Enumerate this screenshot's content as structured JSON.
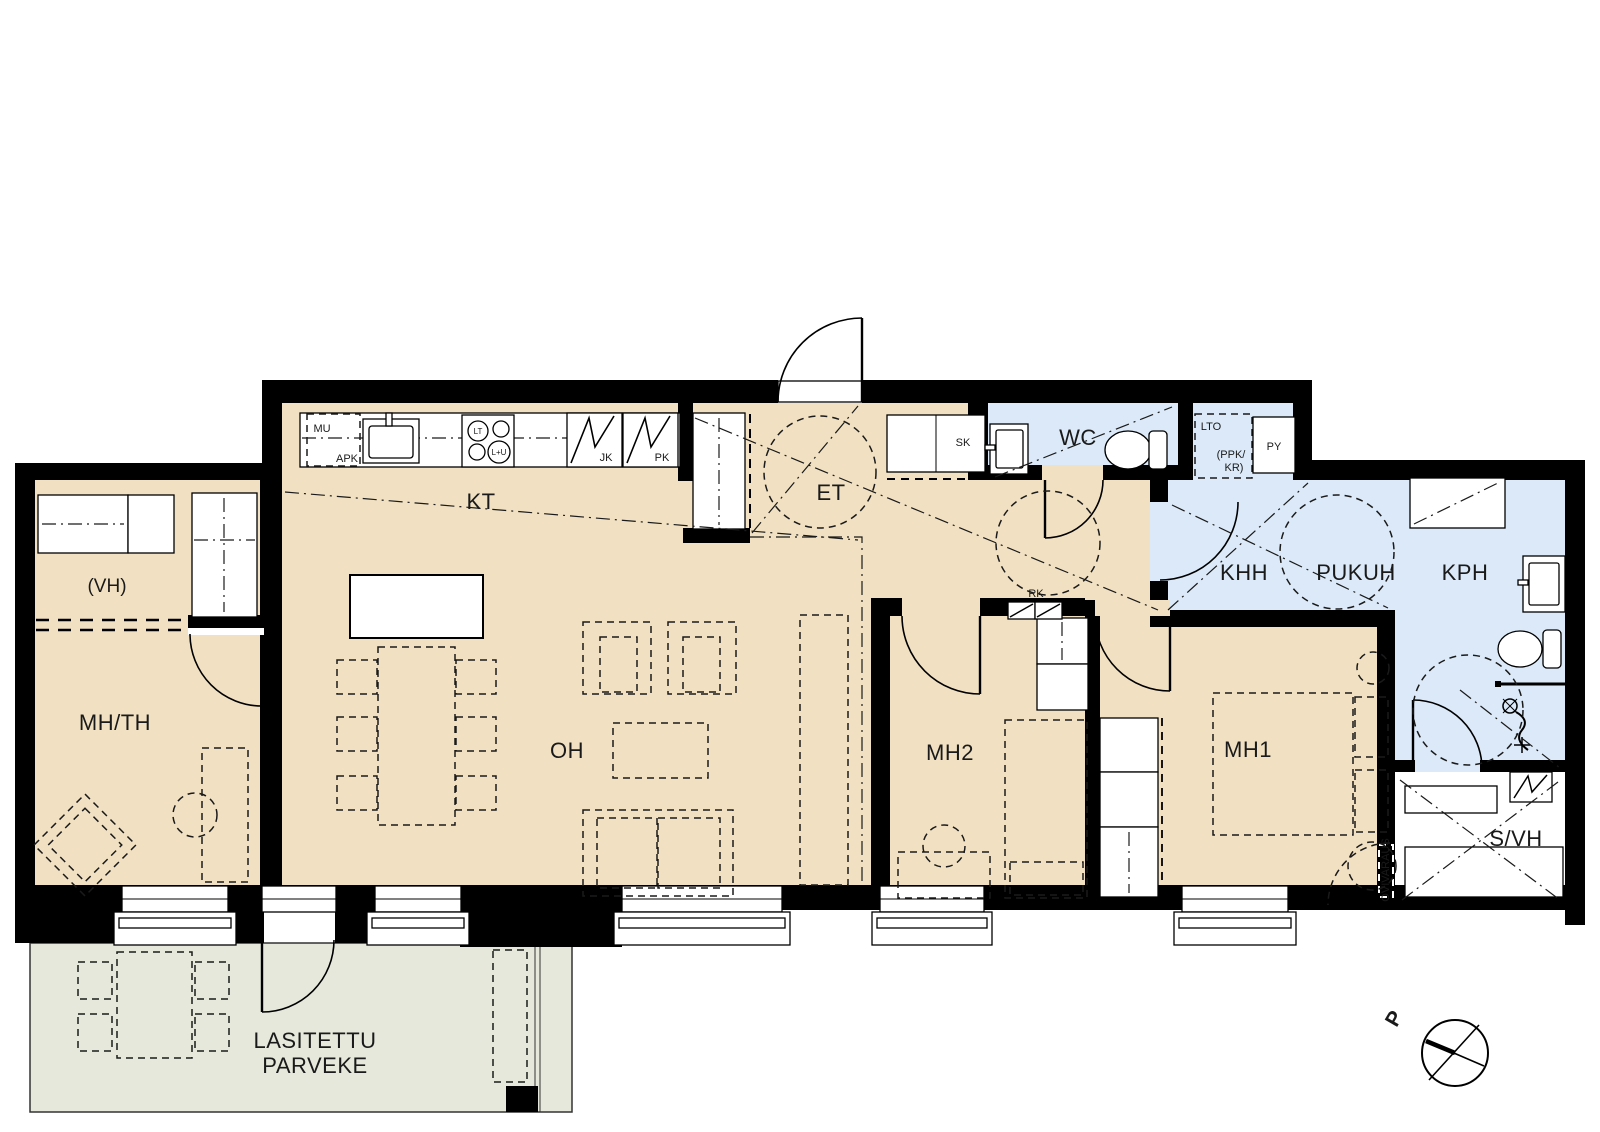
{
  "colors": {
    "floor_dry": "#f1e1c2",
    "floor_wet": "#dbe9f8",
    "balcony": "#e5e8db",
    "wall": "#000000",
    "background": "#ffffff"
  },
  "rooms": {
    "kitchen": "KT",
    "entry": "ET",
    "living": "OH",
    "wc": "WC",
    "utility": "KHH",
    "dressing": "PUKUH",
    "bathroom": "KPH",
    "bedroom1": "MH1",
    "bedroom2": "MH2",
    "bedroom3": "MH/TH",
    "closet_provision": "(VH)",
    "sauna_closet": "S/VH",
    "balcony_line1": "LASITETTU",
    "balcony_line2": "PARVEKE"
  },
  "fixtures": {
    "mu": "MU",
    "apk": "APK",
    "cooktop": "LT",
    "oven": "L+U",
    "fridge": "JK",
    "freezer": "PK",
    "hall_closet": "SK",
    "lto": "LTO",
    "ppk_line1": "(PPK/",
    "ppk_line2": "KR)",
    "py": "PY",
    "rk": "RK",
    "door_provision": "OVIVARAUS"
  },
  "compass": {
    "north": "P"
  }
}
